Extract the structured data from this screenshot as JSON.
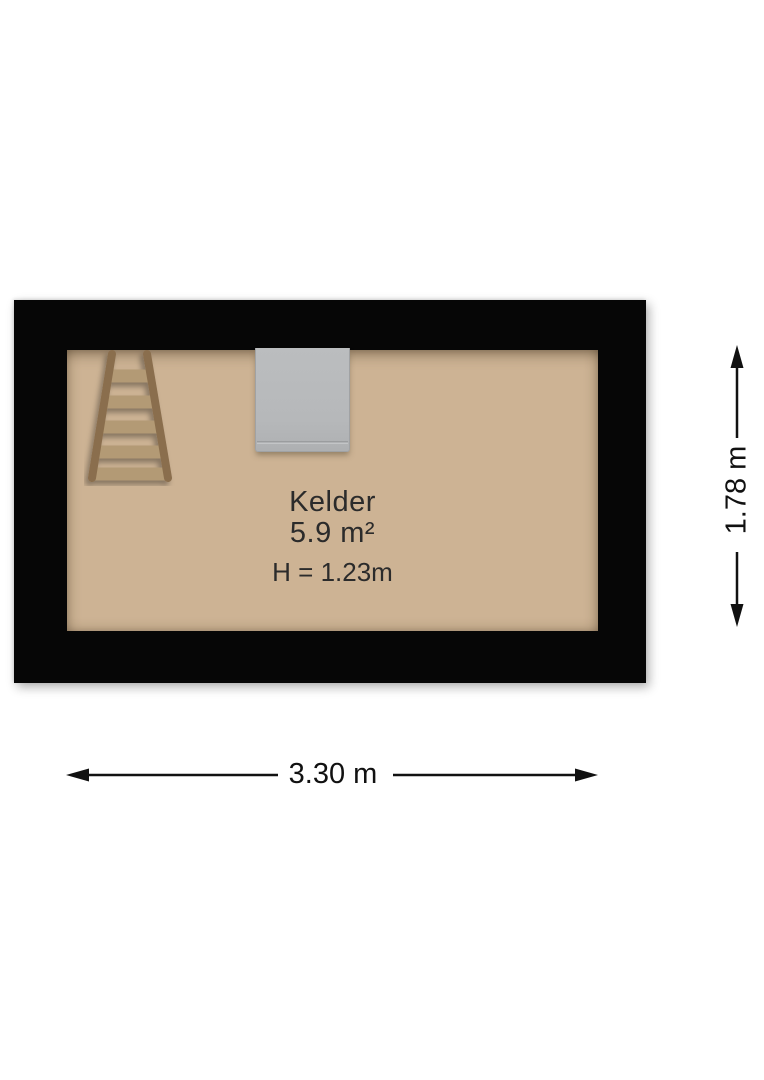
{
  "plan": {
    "room": {
      "name": "Kelder",
      "area": "5.9 m²",
      "ceiling_height": "H = 1.23m"
    },
    "dimensions": {
      "width": "3.30 m",
      "height": "1.78 m"
    },
    "objects": {
      "ladder": "wooden-ladder",
      "appliance": "boiler-unit"
    },
    "colors": {
      "wall": "#060606",
      "floor": "#cdb394",
      "label_text": "#2b2b2b",
      "dimension": "#111111",
      "appliance_fill": "#b7b9bb",
      "ladder_rail": "#8a6e4d",
      "ladder_rung": "#b39a74"
    }
  }
}
